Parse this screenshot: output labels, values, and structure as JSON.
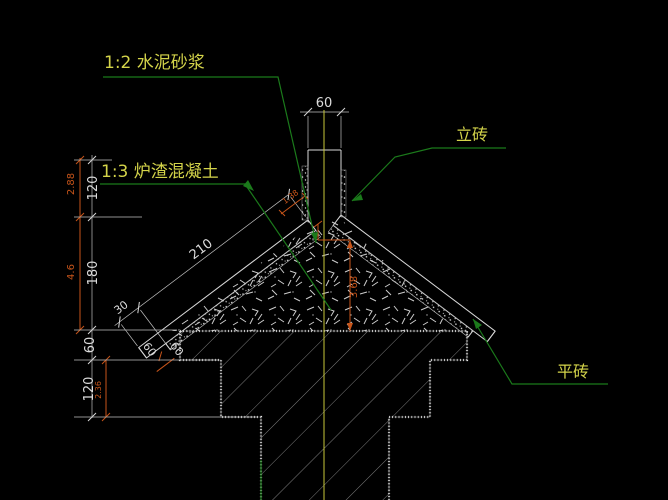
{
  "drawing": {
    "type": "cad-roof-ridge-detail",
    "labels": {
      "cement_mortar": "1:2 水泥砂浆",
      "cinder_concrete": "1:3 炉渣混凝土",
      "vertical_brick": "立砖",
      "flat_brick": "平砖"
    },
    "dims": {
      "ridge_width": "60",
      "slope_length": "210",
      "eave_offset": "30",
      "eave_course_a": "60",
      "eave_course_b": "60",
      "chain_1": "120",
      "chain_2": "180",
      "chain_3": "60",
      "chain_4": "120",
      "red_1": "2.88",
      "red_2": "4.6",
      "red_3": "2.36",
      "red_center": "3.68",
      "red_ridge": "1.38"
    },
    "colors": {
      "background": "#000000",
      "line_white": "#d8d8d8",
      "hatch_gray": "#7d7d7d",
      "label_yellow": "#d4d44a",
      "leader_green": "#1b7a1b",
      "dim_red": "#c8551a",
      "centerline_yellow": "#c9c93a"
    }
  }
}
